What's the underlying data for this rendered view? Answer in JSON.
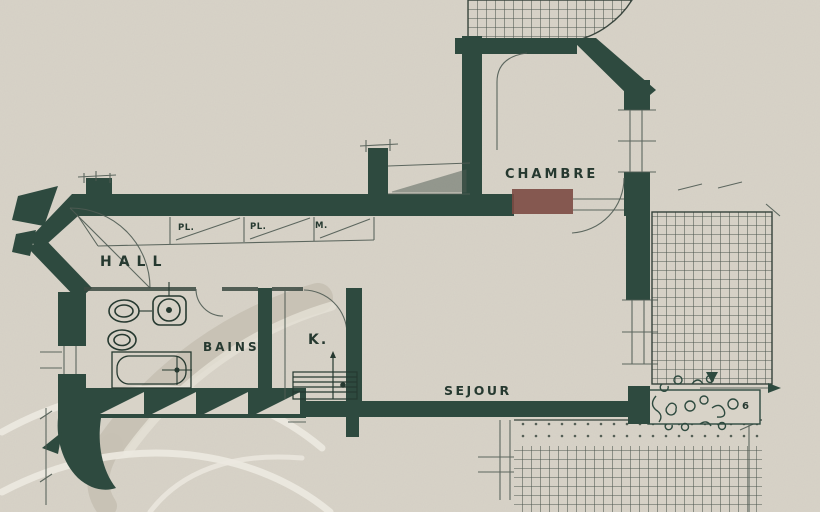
{
  "document": {
    "type": "apartment-floor-plan-scan",
    "language": "French"
  },
  "colors": {
    "paper": "#d8d3c8",
    "ink": "#2e4a3f",
    "pencil": "#4f5b53",
    "accent_red": "#7c4a43",
    "watermark": "#c7c1b4",
    "highlight": "#ece9e0"
  },
  "rooms": {
    "hall": {
      "label": "HALL"
    },
    "bains": {
      "label": "BAINS"
    },
    "kitchen": {
      "label": "K."
    },
    "sejour": {
      "label": "SEJOUR"
    },
    "chambre": {
      "label": "CHAMBRE"
    }
  },
  "closet_labels": [
    "PL.",
    "PL.",
    "M."
  ],
  "annotations": {
    "terrace_note": "6"
  },
  "features": [
    "entry-door-swing",
    "three-hall-closets",
    "wc",
    "bidet",
    "washbasin",
    "bathtub",
    "kitchen-counter",
    "balcony-triangle-hatch",
    "terrace-grid-top",
    "terrace-grid-right",
    "terrace-grid-bottom",
    "planter-box",
    "red-radiator-block",
    "watermark-monogram"
  ]
}
